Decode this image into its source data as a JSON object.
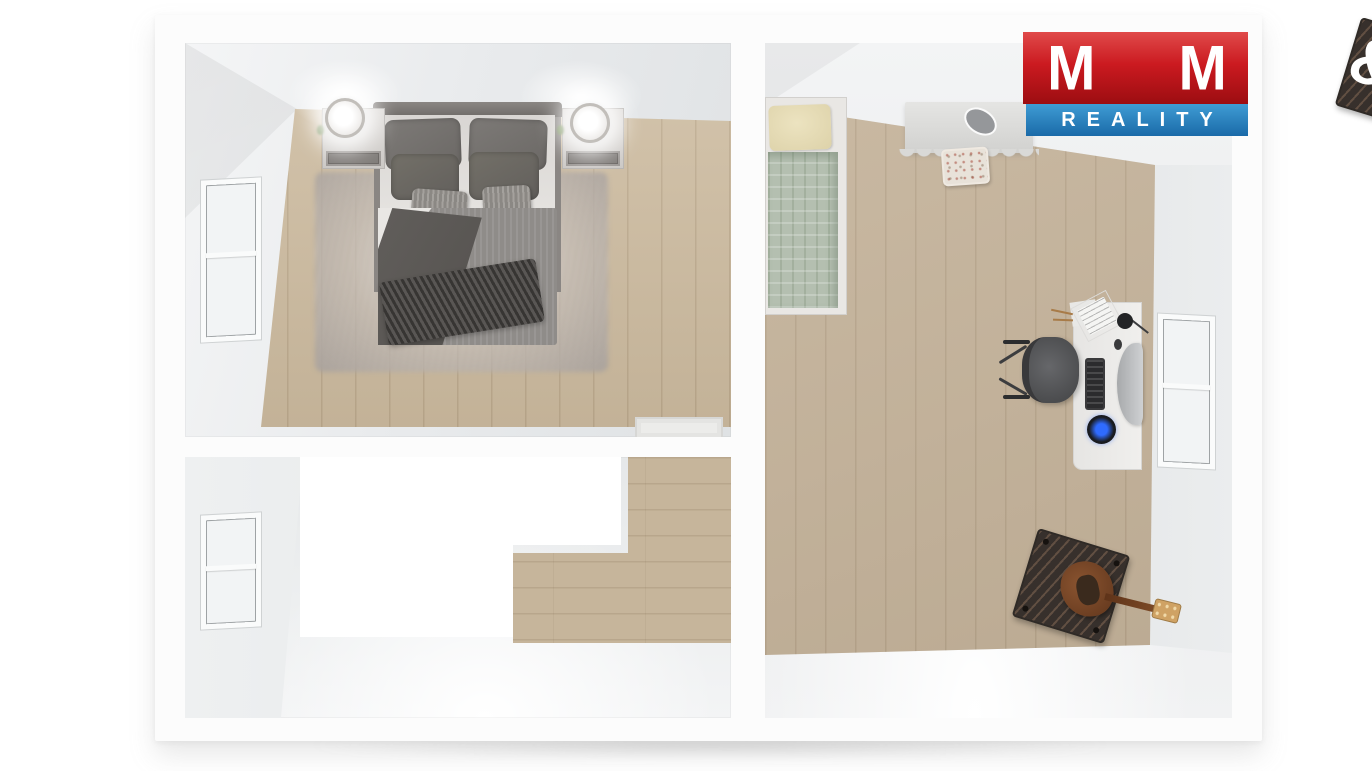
{
  "meta": {
    "kind": "3d-floorplan-top-down-render",
    "background": "#ffffff"
  },
  "logo": {
    "m_left": "M",
    "amp": "&",
    "m_right": "M",
    "line2": "REALITY",
    "red_top": "#e04a4a",
    "red_bottom": "#9c0d11",
    "blue_top": "#3f9cd4",
    "blue_bottom": "#1a6aa8",
    "text_color": "#ffffff"
  },
  "palette": {
    "wall_band": "#fcfcfc",
    "wall_face_light": "#f3f4f5",
    "wall_face_dark": "#d9dbdd",
    "bedroom_wood": "#cdbb9f",
    "right_room_wood": "#c4b299",
    "landing_wood": "#c6b59b",
    "screed_floor": "#edeff0",
    "stair_void": "#ffffff",
    "duvet_gray": "#8f8c89",
    "duvet_green": "#b4bfb0",
    "pillow_cream": "#e7ddb5",
    "rug_gray": "#c2bbb7",
    "amp_brown": "#473f3a",
    "guitar_brown": "#7a4a2c",
    "speaker_blue": "#2f6bff"
  },
  "rooms": [
    {
      "name": "bedroom-top-left",
      "floor": "wood",
      "features": [
        "double-bed",
        "gray-rug",
        "nightstand-left",
        "nightstand-right",
        "lamp-left",
        "lamp-right",
        "window-left-wall",
        "door-threshold-bottom-wall"
      ]
    },
    {
      "name": "stair-room-bottom-left",
      "floor": "gray-screed",
      "features": [
        "stair-void",
        "wood-landing",
        "window-left-wall"
      ]
    },
    {
      "name": "room-right",
      "floor": "wood",
      "features": [
        "single-bed-green",
        "vanity-table",
        "vanity-stool",
        "desk",
        "curved-monitor",
        "keyboard",
        "led-speaker",
        "desk-lamp",
        "office-chair",
        "guitar-amp",
        "electric-guitar",
        "window-right-wall"
      ]
    }
  ]
}
